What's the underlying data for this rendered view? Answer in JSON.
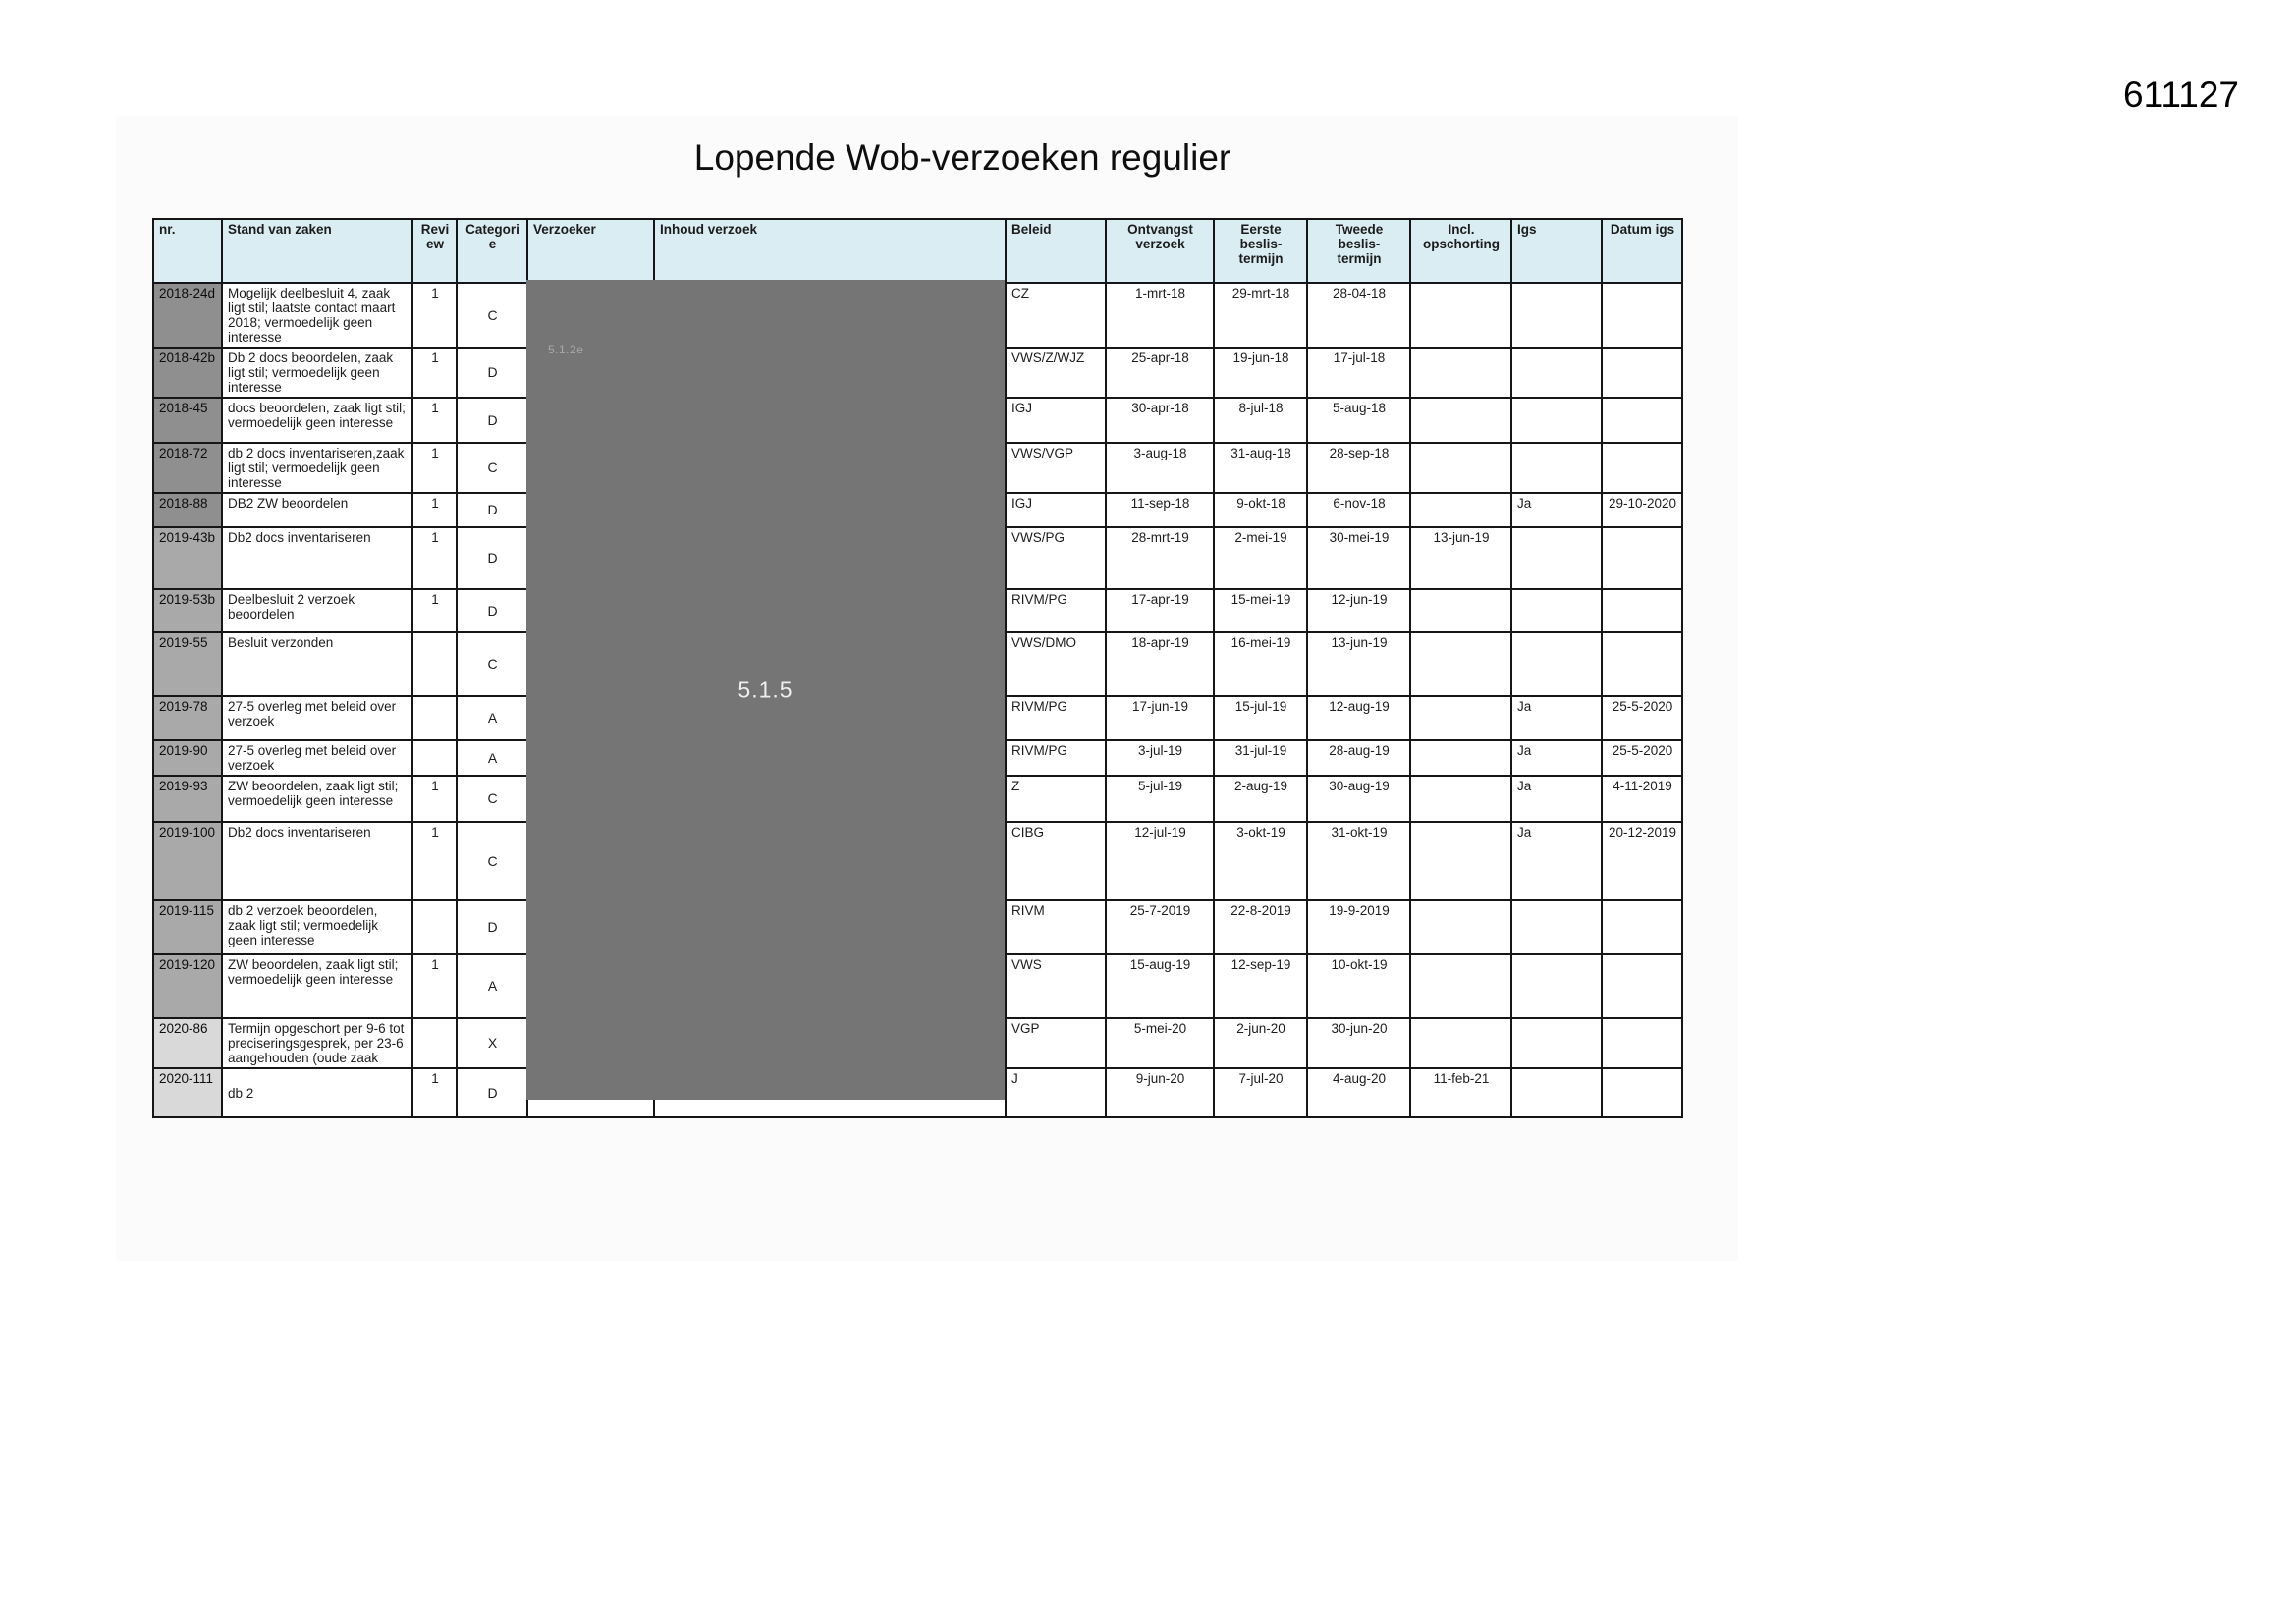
{
  "page": {
    "number": "611127",
    "title": "Lopende Wob-verzoeken regulier"
  },
  "redaction": {
    "label_top": "5.1.2e",
    "label_center": "5.1.5"
  },
  "colors": {
    "header_bg": "#d9edf3",
    "nr_2018": "#8f8f8f",
    "nr_2019": "#a9a9a9",
    "nr_2020": "#d9d9d9",
    "redaction_bg": "#757575",
    "border": "#161616"
  },
  "table": {
    "columns": [
      "nr.",
      "Stand van zaken",
      "Review",
      "Categorie",
      "Verzoeker",
      "Inhoud verzoek",
      "Beleid",
      "Ontvangst\nverzoek",
      "Eerste beslis-\ntermijn",
      "Tweede beslis-\ntermijn",
      "Incl.\nopschorting",
      "Igs",
      "Datum igs"
    ],
    "rows": [
      {
        "nr": "2018-24d",
        "stand": "Mogelijk deelbesluit 4, zaak ligt stil; laatste contact maart 2018; vermoedelijk geen interesse",
        "review": "1",
        "categorie": "C",
        "beleid": "CZ",
        "ontvangst": "1-mrt-18",
        "eerste": "29-mrt-18",
        "tweede": "28-04-18",
        "opschorting": "",
        "igs": "",
        "datum_igs": ""
      },
      {
        "nr": "2018-42b",
        "stand": "Db 2 docs beoordelen, zaak ligt stil; vermoedelijk geen interesse",
        "review": "1",
        "categorie": "D",
        "beleid": "VWS/Z/WJZ",
        "ontvangst": "25-apr-18",
        "eerste": "19-jun-18",
        "tweede": "17-jul-18",
        "opschorting": "",
        "igs": "",
        "datum_igs": ""
      },
      {
        "nr": "2018-45",
        "stand": "docs beoordelen, zaak ligt stil; vermoedelijk geen interesse",
        "review": "1",
        "categorie": "D",
        "beleid": "IGJ",
        "ontvangst": "30-apr-18",
        "eerste": "8-jul-18",
        "tweede": "5-aug-18",
        "opschorting": "",
        "igs": "",
        "datum_igs": ""
      },
      {
        "nr": "2018-72",
        "stand": "db 2 docs inventariseren,zaak ligt stil; vermoedelijk geen interesse",
        "review": "1",
        "categorie": "C",
        "beleid": "VWS/VGP",
        "ontvangst": "3-aug-18",
        "eerste": "31-aug-18",
        "tweede": "28-sep-18",
        "opschorting": "",
        "igs": "",
        "datum_igs": ""
      },
      {
        "nr": "2018-88",
        "stand": "DB2 ZW beoordelen",
        "review": "1",
        "categorie": "D",
        "beleid": "IGJ",
        "ontvangst": "11-sep-18",
        "eerste": "9-okt-18",
        "tweede": "6-nov-18",
        "opschorting": "",
        "igs": "Ja",
        "datum_igs": "29-10-2020"
      },
      {
        "nr": "2019-43b",
        "stand": "Db2 docs inventariseren",
        "review": "1",
        "categorie": "D",
        "beleid": "VWS/PG",
        "ontvangst": "28-mrt-19",
        "eerste": "2-mei-19",
        "tweede": "30-mei-19",
        "opschorting": "13-jun-19",
        "igs": "",
        "datum_igs": ""
      },
      {
        "nr": "2019-53b",
        "stand": "Deelbesluit 2 verzoek beoordelen",
        "review": "1",
        "categorie": "D",
        "beleid": "RIVM/PG",
        "ontvangst": "17-apr-19",
        "eerste": "15-mei-19",
        "tweede": "12-jun-19",
        "opschorting": "",
        "igs": "",
        "datum_igs": ""
      },
      {
        "nr": "2019-55",
        "stand": "Besluit verzonden",
        "review": "",
        "categorie": "C",
        "beleid": "VWS/DMO",
        "ontvangst": "18-apr-19",
        "eerste": "16-mei-19",
        "tweede": "13-jun-19",
        "opschorting": "",
        "igs": "",
        "datum_igs": ""
      },
      {
        "nr": "2019-78",
        "stand": "27-5 overleg met beleid over verzoek",
        "review": "",
        "categorie": "A",
        "beleid": "RIVM/PG",
        "ontvangst": "17-jun-19",
        "eerste": "15-jul-19",
        "tweede": "12-aug-19",
        "opschorting": "",
        "igs": "Ja",
        "datum_igs": "25-5-2020"
      },
      {
        "nr": "2019-90",
        "stand": "27-5 overleg met beleid over verzoek",
        "review": "",
        "categorie": "A",
        "beleid": "RIVM/PG",
        "ontvangst": "3-jul-19",
        "eerste": "31-jul-19",
        "tweede": "28-aug-19",
        "opschorting": "",
        "igs": "Ja",
        "datum_igs": "25-5-2020"
      },
      {
        "nr": "2019-93",
        "stand": "ZW beoordelen, zaak ligt stil; vermoedelijk geen interesse",
        "review": "1",
        "categorie": "C",
        "beleid": "Z",
        "ontvangst": "5-jul-19",
        "eerste": "2-aug-19",
        "tweede": "30-aug-19",
        "opschorting": "",
        "igs": "Ja",
        "datum_igs": "4-11-2019"
      },
      {
        "nr": "2019-100",
        "stand": "Db2 docs inventariseren",
        "review": "1",
        "categorie": "C",
        "beleid": "CIBG",
        "ontvangst": "12-jul-19",
        "eerste": "3-okt-19",
        "tweede": "31-okt-19",
        "opschorting": "",
        "igs": "Ja",
        "datum_igs": "20-12-2019"
      },
      {
        "nr": "2019-115",
        "stand": "db 2 verzoek beoordelen, zaak ligt stil; vermoedelijk geen interesse",
        "review": "",
        "categorie": "D",
        "beleid": "RIVM",
        "ontvangst": "25-7-2019",
        "eerste": "22-8-2019",
        "tweede": "19-9-2019",
        "opschorting": "",
        "igs": "",
        "datum_igs": ""
      },
      {
        "nr": "2019-120",
        "stand": "ZW beoordelen, zaak ligt stil; vermoedelijk geen interesse",
        "review": "1",
        "categorie": "A",
        "beleid": "VWS",
        "ontvangst": "15-aug-19",
        "eerste": "12-sep-19",
        "tweede": "10-okt-19",
        "opschorting": "",
        "igs": "",
        "datum_igs": ""
      },
      {
        "nr": "2020-86",
        "stand": "Termijn opgeschort per 9-6 tot preciseringsgesprek, per 23-6 aangehouden (oude zaak",
        "review": "",
        "categorie": "X",
        "beleid": "VGP",
        "ontvangst": "5-mei-20",
        "eerste": "2-jun-20",
        "tweede": "30-jun-20",
        "opschorting": "",
        "igs": "",
        "datum_igs": ""
      },
      {
        "nr": "2020-111",
        "stand": "\ndb 2",
        "review": "1",
        "categorie": "D",
        "beleid": "J",
        "ontvangst": "9-jun-20",
        "eerste": "7-jul-20",
        "tweede": "4-aug-20",
        "opschorting": "11-feb-21",
        "igs": "",
        "datum_igs": ""
      }
    ]
  }
}
